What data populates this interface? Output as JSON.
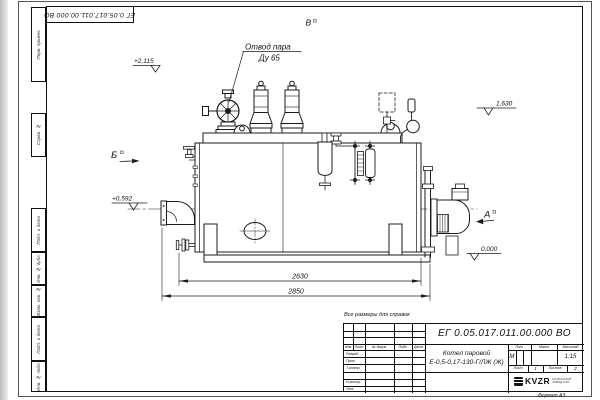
{
  "sheet": {
    "format_note": "Формат А3",
    "ref_note": "Все размеры для справок"
  },
  "top_stamp": {
    "designation": "ЕГ 0.05.017.011.00.000  ВО"
  },
  "side_stamps": [
    "Перв. примен.",
    "Справ. №",
    "Подп. и дата",
    "Инв. № дубл.",
    "Взам. инв. №",
    "Подп. и дата",
    "Инв. № подл."
  ],
  "tb": {
    "designation": "ЕГ 0.05.017.011.00.000  ВО",
    "product_line1": "Котел паровой",
    "product_line2": "Е-0,5-0,17-130-Г/ЛЖ (Ж)",
    "col_headers": [
      "Изм.",
      "Лист",
      "№ докум.",
      "Подп.",
      "Дата"
    ],
    "rows": [
      "Разраб.",
      "Пров.",
      "Т.контр.",
      "Н.контр.",
      "Утв."
    ],
    "lit_header": "Лит.",
    "lit_value": "М",
    "mass_header": "Масса",
    "scale_header": "Масштаб",
    "scale_value": "1:15",
    "sheet_label": "Лист",
    "sheet_value": "1",
    "sheets_label": "Листов",
    "sheets_value": "2",
    "logo": "KVZR",
    "logo_sub1": "КОТЕЛЬНЫЙ",
    "logo_sub2": "ЗАВОД РЭП"
  },
  "annotations": {
    "steam_line1": "Отвод пара",
    "steam_line2": "Ду 65",
    "view_a": "А",
    "view_b": "Б",
    "view_v": "В",
    "elev_top": "+2,115",
    "elev_front": "+0,592",
    "elev_right": "1,630",
    "elev_zero": "0,000",
    "dim_body": "2630",
    "dim_overall": "2850"
  }
}
